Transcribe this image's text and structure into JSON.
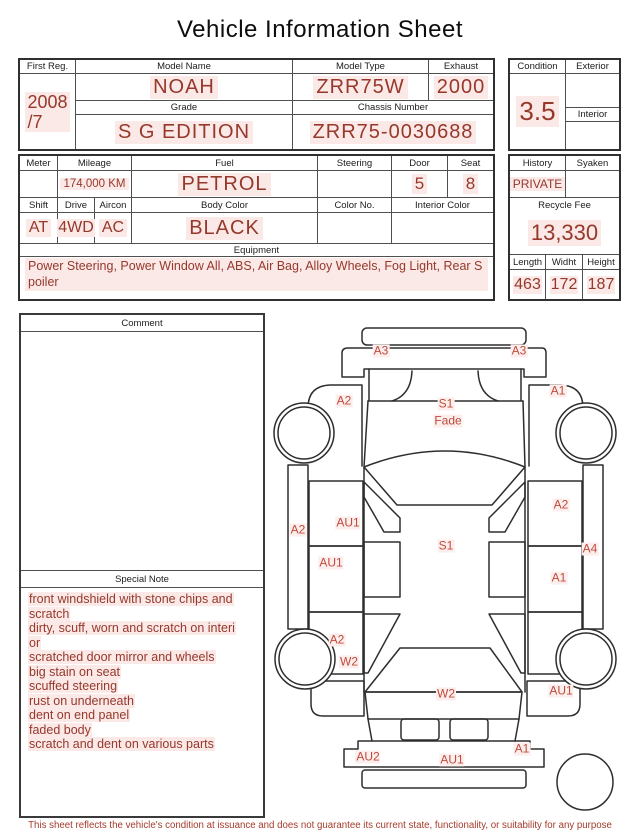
{
  "title": "Vehicle Information Sheet",
  "table1": {
    "first_reg_label": "First Reg.",
    "first_reg_year": "2008",
    "first_reg_month": "/7",
    "model_name_label": "Model Name",
    "model_name": "NOAH",
    "model_type_label": "Model Type",
    "model_type": "ZRR75W",
    "exhaust_label": "Exhaust",
    "exhaust": "2000",
    "grade_label": "Grade",
    "grade": "S G EDITION",
    "chassis_label": "Chassis Number",
    "chassis_number": "ZRR75-0030688",
    "condition_label": "Condition",
    "condition_score": "3.5",
    "exterior_label": "Exterior",
    "exterior": "",
    "interior_label": "Interior",
    "interior": ""
  },
  "table2": {
    "meter_label": "Meter",
    "meter": "",
    "mileage_label": "Mileage",
    "mileage": "174,000 KM",
    "fuel_label": "Fuel",
    "fuel": "PETROL",
    "steering_label": "Steering",
    "steering": "",
    "door_label": "Door",
    "door": "5",
    "seat_label": "Seat",
    "seat": "8",
    "shift_label": "Shift",
    "shift": "AT",
    "drive_label": "Drive",
    "drive": "4WD",
    "aircon_label": "Aircon",
    "aircon": "AC",
    "body_color_label": "Body Color",
    "body_color": "BLACK",
    "color_no_label": "Color No.",
    "color_no": "",
    "interior_color_label": "Interior Color",
    "interior_color": "",
    "equipment_label": "Equipment",
    "equipment": "Power Steering, Power Window  All, ABS, Air Bag, Alloy Wheels, Fog Light, Rear Spoiler",
    "history_label": "History",
    "history": "PRIVATE",
    "syaken_label": "Syaken",
    "syaken": "",
    "recycle_fee_label": "Recycle Fee",
    "recycle_fee": "13,330",
    "length_label": "Length",
    "length": "463",
    "width_label": "Widht",
    "width": "172",
    "height_label": "Height",
    "height": "187"
  },
  "comment": {
    "label": "Comment",
    "text": ""
  },
  "special_note": {
    "label": "Special Note",
    "lines": [
      "front windshield with stone chips and scratch",
      "dirty, scuff, worn and scratch on interior",
      "scratched door mirror and wheels",
      "big stain on seat",
      "scuffed steering",
      "rust on underneath",
      "dent on end panel",
      "faded body",
      "scratch and dent on various parts"
    ]
  },
  "diagram": {
    "markers": [
      {
        "label": "A3",
        "part": "front-bumper-left",
        "x": 117,
        "y": 36
      },
      {
        "label": "A3",
        "part": "front-bumper-right",
        "x": 255,
        "y": 36
      },
      {
        "label": "A2",
        "part": "front-fender-left",
        "x": 80,
        "y": 86
      },
      {
        "label": "A1",
        "part": "front-fender-right",
        "x": 294,
        "y": 76
      },
      {
        "label": "S1",
        "part": "hood",
        "x": 182,
        "y": 89
      },
      {
        "label": "Fade",
        "part": "hood-fade",
        "x": 184,
        "y": 106
      },
      {
        "label": "A2",
        "part": "left-rocker-panel",
        "x": 34,
        "y": 215
      },
      {
        "label": "AU1",
        "part": "front-door-left",
        "x": 84,
        "y": 208
      },
      {
        "label": "A2",
        "part": "front-door-right",
        "x": 297,
        "y": 190
      },
      {
        "label": "S1",
        "part": "roof",
        "x": 182,
        "y": 231
      },
      {
        "label": "A4",
        "part": "right-rocker-panel",
        "x": 326,
        "y": 234
      },
      {
        "label": "AU1",
        "part": "sliding-door-left",
        "x": 67,
        "y": 248
      },
      {
        "label": "A1",
        "part": "rear-door-right",
        "x": 295,
        "y": 263
      },
      {
        "label": "A2",
        "part": "rear-quarter-left",
        "x": 73,
        "y": 325
      },
      {
        "label": "W2",
        "part": "rear-wheel-left",
        "x": 85,
        "y": 347
      },
      {
        "label": "W2",
        "part": "rear-window",
        "x": 182,
        "y": 379
      },
      {
        "label": "AU1",
        "part": "rear-quarter-right",
        "x": 297,
        "y": 376
      },
      {
        "label": "AU2",
        "part": "rear-bumper-left",
        "x": 104,
        "y": 442
      },
      {
        "label": "AU1",
        "part": "rear-bumper-center",
        "x": 188,
        "y": 445
      },
      {
        "label": "A1",
        "part": "rear-bumper-right",
        "x": 258,
        "y": 434
      }
    ]
  },
  "footer": {
    "disclaimer": "This sheet reflects the vehicle's condition at issuance and does not guarantee its current state, functionality, or suitability for any purpose"
  }
}
